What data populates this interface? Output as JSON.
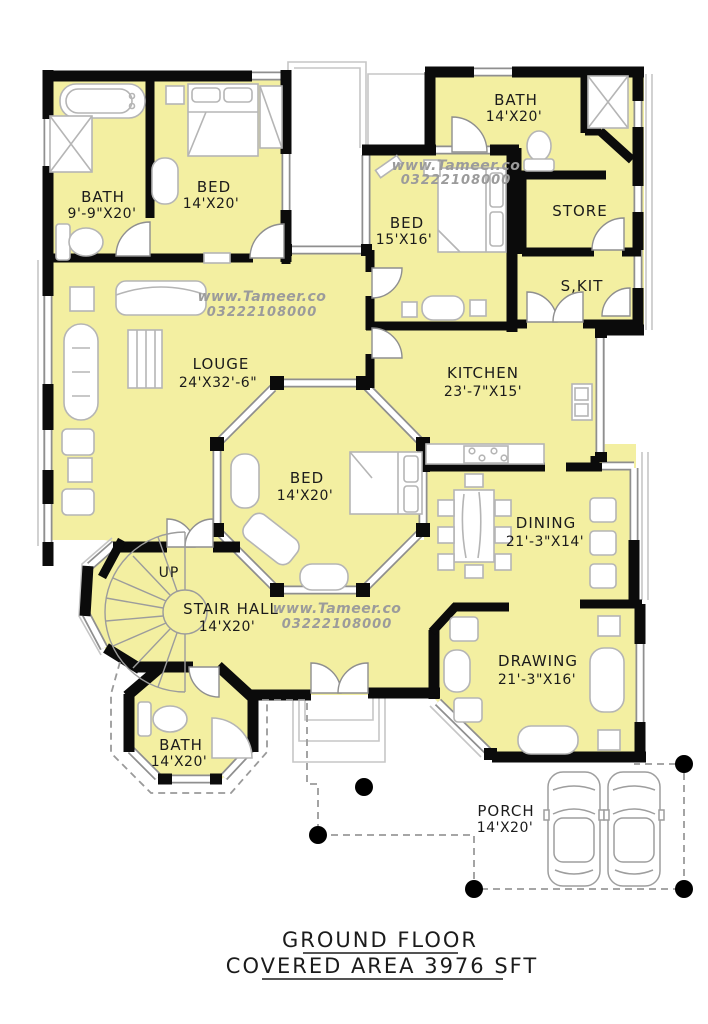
{
  "rooms": {
    "bath_top_left": {
      "label": "BATH",
      "dims": "9'-9\"X20'"
    },
    "bed_top_left": {
      "label": "BED",
      "dims": "14'X20'"
    },
    "bath_top_right": {
      "label": "BATH",
      "dims": "14'X20'"
    },
    "store": {
      "label": "STORE"
    },
    "spare_kitchen": {
      "label": "S,KIT"
    },
    "bed_middle": {
      "label": "BED",
      "dims": "15'X16'"
    },
    "kitchen": {
      "label": "KITCHEN",
      "dims": "23'-7\"X15'"
    },
    "lounge": {
      "label": "LOUGE",
      "dims": "24'X32'-6\""
    },
    "bed_center": {
      "label": "BED",
      "dims": "14'X20'"
    },
    "dining": {
      "label": "DINING",
      "dims": "21'-3\"X14'"
    },
    "stair_hall": {
      "label": "STAIR HALL",
      "dims": "14'X20'"
    },
    "drawing": {
      "label": "DRAWING",
      "dims": "21'-3\"X16'"
    },
    "bath_bottom": {
      "label": "BATH",
      "dims": "14'X20'"
    },
    "porch": {
      "label": "PORCH",
      "dims": "14'X20'"
    }
  },
  "stair": {
    "direction_label": "UP"
  },
  "watermark": {
    "site": "www.Tameer.co",
    "phone": "03222108000"
  },
  "footer": {
    "line1": "GROUND FLOOR",
    "line2": "COVERED AREA 3976 SFT"
  },
  "colors": {
    "floor_fill": "#F3EFA1",
    "wall": "#0B0B0B",
    "window_casing": "#8F8F8F",
    "furniture_line": "#B5B5B5",
    "watermark": "#9B9B9B",
    "label_text": "#1B1B1B",
    "column_dot": "#000000"
  }
}
